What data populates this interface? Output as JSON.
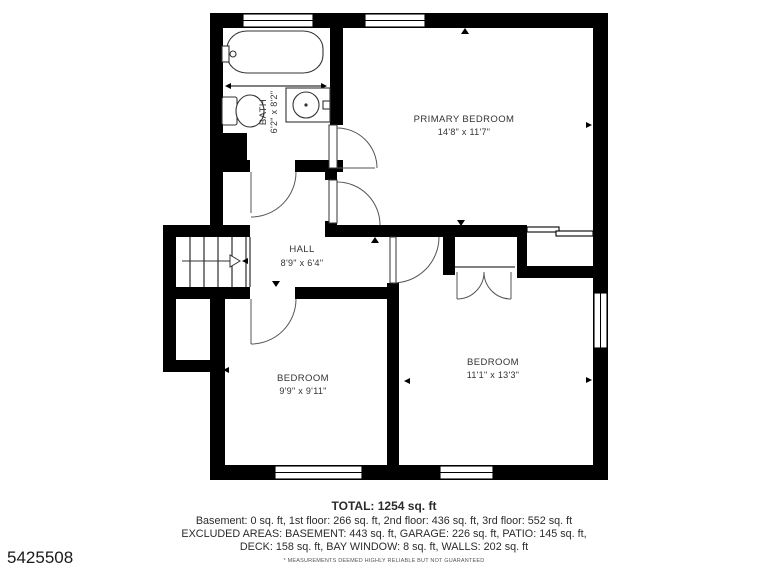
{
  "plan": {
    "rooms": [
      {
        "name": "BATH",
        "dims": "6'2\" x 8'2\""
      },
      {
        "name": "PRIMARY BEDROOM",
        "dims": "14'8\" x 11'7\""
      },
      {
        "name": "HALL",
        "dims": "8'9\" x 6'4\""
      },
      {
        "name": "BEDROOM",
        "dims": "9'9\" x 9'11\""
      },
      {
        "name": "BEDROOM",
        "dims": "11'1\" x 13'3\""
      }
    ],
    "fixtures": [
      "bathtub",
      "toilet",
      "sink-vanity",
      "staircase"
    ]
  },
  "footer": {
    "total": "TOTAL: 1254 sq. ft",
    "line1": "Basement: 0 sq. ft, 1st floor: 266 sq. ft, 2nd floor: 436 sq. ft, 3rd floor: 552 sq. ft",
    "line2": "EXCLUDED AREAS: BASEMENT: 443 sq. ft, GARAGE: 226 sq. ft, PATIO: 145 sq. ft,",
    "line3": "DECK: 158 sq. ft, BAY WINDOW: 8 sq. ft, WALLS: 202 sq. ft",
    "disclaimer": "* MEASUREMENTS DEEMED HIGHLY RELIABLE BUT NOT GUARANTEED"
  },
  "listing_id": "5425508",
  "colors": {
    "wall": "#000000",
    "background": "#ffffff",
    "label_text": "#333333",
    "footer_text": "#2b2b2b"
  }
}
